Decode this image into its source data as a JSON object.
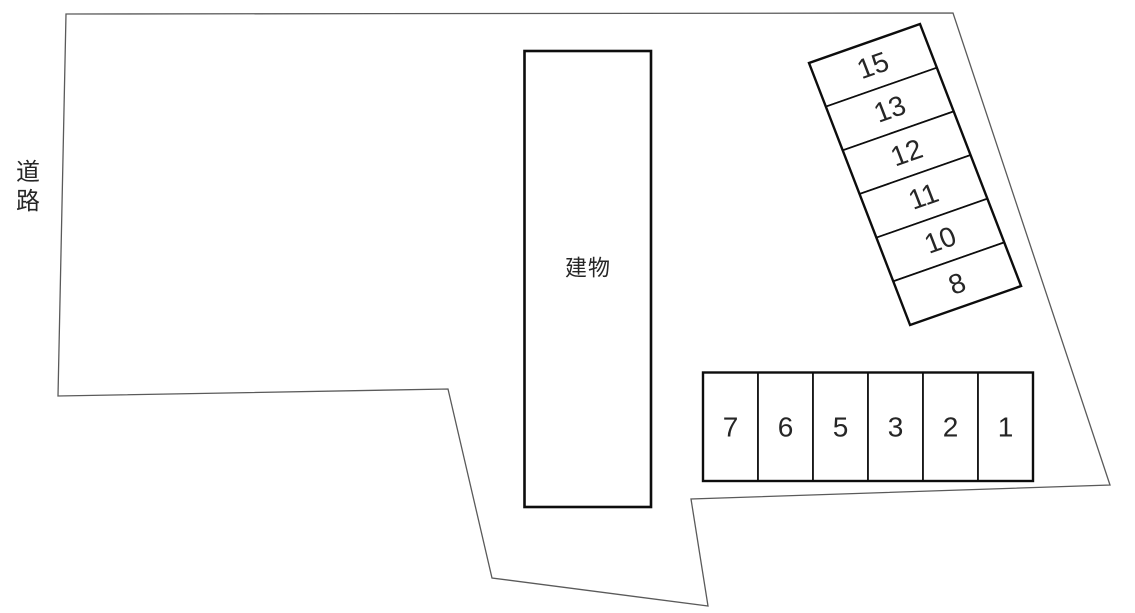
{
  "labels": {
    "road": "道路",
    "building": "建物"
  },
  "parking": {
    "diagonal_stalls": [
      "15",
      "13",
      "12",
      "11",
      "10",
      "8"
    ],
    "row_stalls": [
      "7",
      "6",
      "5",
      "3",
      "2",
      "1"
    ]
  },
  "colors": {
    "stall_outline": "#0d0d0d",
    "boundary_line": "#5a5a5a",
    "text": "#262626",
    "background": "#ffffff"
  }
}
